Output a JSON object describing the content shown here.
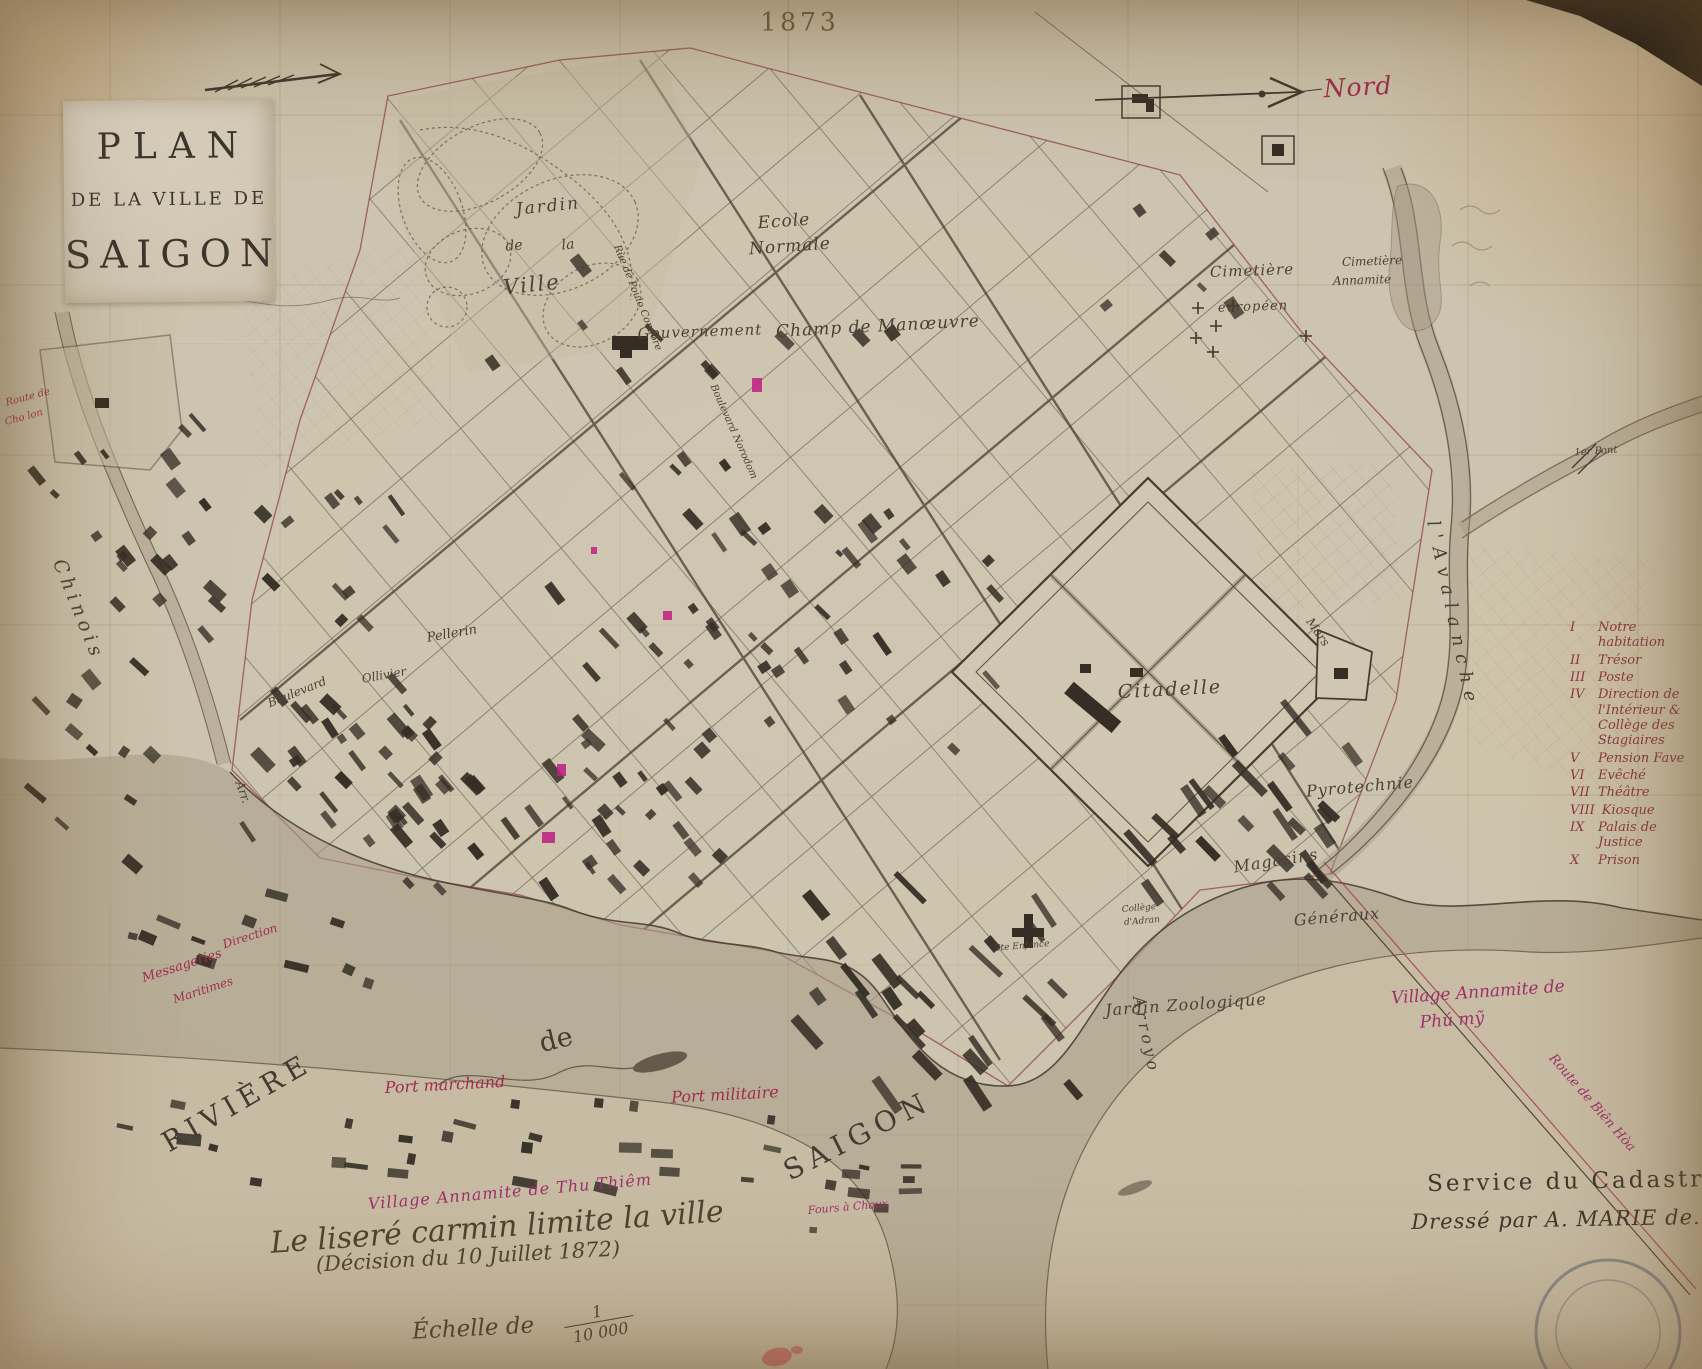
{
  "title_block": {
    "line1": "PLAN",
    "line2": "DE LA VILLE DE",
    "line3": "SAIGON"
  },
  "legend": {
    "items": [
      {
        "numeral": "I",
        "label": "Notre habitation"
      },
      {
        "numeral": "II",
        "label": "Trésor"
      },
      {
        "numeral": "III",
        "label": "Poste"
      },
      {
        "numeral": "IV",
        "label": "Direction de l'Intérieur & Collège des Stagiaires"
      },
      {
        "numeral": "V",
        "label": "Pension Fave"
      },
      {
        "numeral": "VI",
        "label": "Evêché"
      },
      {
        "numeral": "VII",
        "label": "Théâtre"
      },
      {
        "numeral": "VIII",
        "label": "Kiosque"
      },
      {
        "numeral": "IX",
        "label": "Palais de Justice"
      },
      {
        "numeral": "X",
        "label": "Prison"
      }
    ]
  },
  "scale": {
    "label": "Échelle de",
    "numerator": "1",
    "denominator": "10 000"
  },
  "colors": {
    "paper": "#cfc6b2",
    "ink_dark": "#4a4136",
    "ink_red": "#a02c4e",
    "ink_magenta": "#9e3168",
    "marker_pink": "#bf1d82",
    "legend_ink": "#8c3544",
    "water": "#a89a85"
  },
  "map_labels": [
    {
      "id": "year",
      "text": "1873",
      "x": 800,
      "y": 22,
      "rot": 0,
      "size": 25,
      "cls": "plain",
      "sp": 4
    },
    {
      "id": "nord",
      "text": "Nord",
      "x": 1358,
      "y": 87,
      "rot": -3,
      "size": 25,
      "cls": "red",
      "sp": 1
    },
    {
      "id": "jardin",
      "text": "Jardin",
      "x": 548,
      "y": 207,
      "rot": -6,
      "size": 17,
      "cls": "eng",
      "sp": 2
    },
    {
      "id": "jardin-de",
      "text": "de",
      "x": 514,
      "y": 246,
      "rot": -6,
      "size": 14,
      "cls": "eng"
    },
    {
      "id": "jardin-la",
      "text": "la",
      "x": 568,
      "y": 245,
      "rot": -6,
      "size": 14,
      "cls": "eng"
    },
    {
      "id": "jardin-ville",
      "text": "Ville",
      "x": 532,
      "y": 285,
      "rot": -6,
      "size": 21,
      "cls": "eng",
      "sp": 2
    },
    {
      "id": "ecole",
      "text": "Ecole",
      "x": 784,
      "y": 222,
      "rot": -4,
      "size": 17,
      "cls": "eng",
      "sp": 1
    },
    {
      "id": "normale",
      "text": "Normale",
      "x": 790,
      "y": 247,
      "rot": -4,
      "size": 17,
      "cls": "eng",
      "sp": 1
    },
    {
      "id": "gouvernement",
      "text": "Gouvernement",
      "x": 700,
      "y": 332,
      "rot": -2,
      "size": 15,
      "cls": "eng",
      "sp": 1
    },
    {
      "id": "champ",
      "text": "Champ de Manœuvre",
      "x": 878,
      "y": 327,
      "rot": -3,
      "size": 17,
      "cls": "eng",
      "sp": 1
    },
    {
      "id": "cim-eur-1",
      "text": "Cimetière",
      "x": 1252,
      "y": 271,
      "rot": -2,
      "size": 15,
      "cls": "eng",
      "sp": 1
    },
    {
      "id": "cim-eur-2",
      "text": "européen",
      "x": 1253,
      "y": 307,
      "rot": -2,
      "size": 13,
      "cls": "eng",
      "sp": 1
    },
    {
      "id": "cim-ann-1",
      "text": "Cimetière",
      "x": 1372,
      "y": 261,
      "rot": -2,
      "size": 12,
      "cls": "eng"
    },
    {
      "id": "cim-ann-2",
      "text": "Annamite",
      "x": 1362,
      "y": 280,
      "rot": -2,
      "size": 12,
      "cls": "eng"
    },
    {
      "id": "citadelle",
      "text": "Citadelle",
      "x": 1170,
      "y": 690,
      "rot": -3,
      "size": 19,
      "cls": "eng",
      "sp": 2
    },
    {
      "id": "pyrotechnie",
      "text": "Pyrotechnie",
      "x": 1360,
      "y": 787,
      "rot": -5,
      "size": 16,
      "cls": "eng",
      "sp": 1
    },
    {
      "id": "magasins",
      "text": "Magasins",
      "x": 1276,
      "y": 861,
      "rot": -9,
      "size": 16,
      "cls": "eng",
      "sp": 1
    },
    {
      "id": "generaux",
      "text": "Généraux",
      "x": 1337,
      "y": 917,
      "rot": -5,
      "size": 16,
      "cls": "eng",
      "sp": 1
    },
    {
      "id": "zoo",
      "text": "Jardin Zoologique",
      "x": 1186,
      "y": 1005,
      "rot": -4,
      "size": 16,
      "cls": "eng",
      "sp": 1
    },
    {
      "id": "pellerin",
      "text": "Pellerin",
      "x": 452,
      "y": 634,
      "rot": -10,
      "size": 13,
      "cls": "eng"
    },
    {
      "id": "ollivier",
      "text": "Ollivier",
      "x": 384,
      "y": 675,
      "rot": -10,
      "size": 12,
      "cls": "eng"
    },
    {
      "id": "boulevard",
      "text": "Boulevard",
      "x": 297,
      "y": 692,
      "rot": -22,
      "size": 12,
      "cls": "eng"
    },
    {
      "id": "arr",
      "text": "Arr.",
      "x": 243,
      "y": 792,
      "rot": 70,
      "size": 12,
      "cls": "eng"
    },
    {
      "id": "chinois",
      "text": "Chinois",
      "x": 78,
      "y": 610,
      "rot": 68,
      "size": 19,
      "cls": "eng",
      "sp": 5
    },
    {
      "id": "riviere",
      "text": "RIVIÈRE",
      "x": 237,
      "y": 1103,
      "rot": -30,
      "size": 28,
      "cls": "caps",
      "sp": 6
    },
    {
      "id": "riviere-de",
      "text": "de",
      "x": 556,
      "y": 1040,
      "rot": -14,
      "size": 27,
      "cls": "caps"
    },
    {
      "id": "saigon-river",
      "text": "SAIGON",
      "x": 858,
      "y": 1136,
      "rot": -27,
      "size": 28,
      "cls": "caps",
      "sp": 7
    },
    {
      "id": "arroyo",
      "text": "Arroyo",
      "x": 1146,
      "y": 1035,
      "rot": 78,
      "size": 16,
      "cls": "eng",
      "sp": 4
    },
    {
      "id": "avalanche",
      "text": "l'Avalanche",
      "x": 1452,
      "y": 615,
      "rot": 78,
      "size": 18,
      "cls": "eng",
      "sp": 8
    },
    {
      "id": "rue-poulo",
      "text": "Rue de Poulo Condore",
      "x": 637,
      "y": 298,
      "rot": 68,
      "size": 10,
      "cls": "eng"
    },
    {
      "id": "bd-norodom",
      "text": "Boulevard Norodom",
      "x": 733,
      "y": 432,
      "rot": 66,
      "size": 10,
      "cls": "eng"
    },
    {
      "id": "premier-pont",
      "text": "1er Pont",
      "x": 1596,
      "y": 452,
      "rot": -4,
      "size": 10,
      "cls": "eng"
    },
    {
      "id": "mars",
      "text": "Mars",
      "x": 1318,
      "y": 632,
      "rot": 55,
      "size": 12,
      "cls": "eng"
    },
    {
      "id": "college-1",
      "text": "Collège",
      "x": 1139,
      "y": 909,
      "rot": -5,
      "size": 9,
      "cls": "eng"
    },
    {
      "id": "college-2",
      "text": "d'Adran",
      "x": 1142,
      "y": 922,
      "rot": -5,
      "size": 9,
      "cls": "eng"
    },
    {
      "id": "ste-enfance",
      "text": "Ste Enfance",
      "x": 1022,
      "y": 947,
      "rot": -5,
      "size": 9,
      "cls": "eng"
    },
    {
      "id": "messageries",
      "text": "Messageries",
      "x": 182,
      "y": 966,
      "rot": -18,
      "size": 13,
      "cls": "red"
    },
    {
      "id": "direction",
      "text": "Direction",
      "x": 250,
      "y": 936,
      "rot": -18,
      "size": 12,
      "cls": "red"
    },
    {
      "id": "maritimes",
      "text": "Maritimes",
      "x": 203,
      "y": 990,
      "rot": -18,
      "size": 12,
      "cls": "red"
    },
    {
      "id": "port-marchand",
      "text": "Port marchand",
      "x": 445,
      "y": 1085,
      "rot": -3,
      "size": 16,
      "cls": "red"
    },
    {
      "id": "port-militaire",
      "text": "Port militaire",
      "x": 725,
      "y": 1095,
      "rot": -3,
      "size": 16,
      "cls": "red"
    },
    {
      "id": "village-thuthiem",
      "text": "Village Annamite de Thu Thiêm",
      "x": 510,
      "y": 1192,
      "rot": -5,
      "size": 16,
      "cls": "red2",
      "sp": 1
    },
    {
      "id": "village-phumy-1",
      "text": "Village Annamite de",
      "x": 1478,
      "y": 993,
      "rot": -4,
      "size": 17,
      "cls": "red2"
    },
    {
      "id": "village-phumy-2",
      "text": "Phú mỹ",
      "x": 1452,
      "y": 1021,
      "rot": -4,
      "size": 17,
      "cls": "red2"
    },
    {
      "id": "route-bienhoa",
      "text": "Route de Biên Hòa",
      "x": 1592,
      "y": 1103,
      "rot": 49,
      "size": 13,
      "cls": "red2"
    },
    {
      "id": "route-left-1",
      "text": "Route de",
      "x": 28,
      "y": 398,
      "rot": -15,
      "size": 10,
      "cls": "red"
    },
    {
      "id": "route-left-2",
      "text": "Cho lon",
      "x": 24,
      "y": 418,
      "rot": -15,
      "size": 10,
      "cls": "red"
    },
    {
      "id": "fours",
      "text": "Fours à Chaux",
      "x": 848,
      "y": 1207,
      "rot": -5,
      "size": 11,
      "cls": "red2"
    },
    {
      "id": "limit-note-1",
      "text": "Le liseré carmin limite la ville",
      "x": 497,
      "y": 1228,
      "rot": -4,
      "size": 30,
      "cls": "script"
    },
    {
      "id": "limit-note-2",
      "text": "(Décision du 10 Juillet 1872)",
      "x": 468,
      "y": 1257,
      "rot": -3,
      "size": 21,
      "cls": "script"
    },
    {
      "id": "cadastre-1",
      "text": "Service du Cadastre",
      "x": 1574,
      "y": 1182,
      "rot": -1,
      "size": 23,
      "cls": "cad",
      "sp": 3
    },
    {
      "id": "cadastre-2",
      "text": "Dressé par A. MARIE de.",
      "x": 1556,
      "y": 1220,
      "rot": -1,
      "size": 21,
      "cls": "cad-it",
      "sp": 1
    }
  ]
}
